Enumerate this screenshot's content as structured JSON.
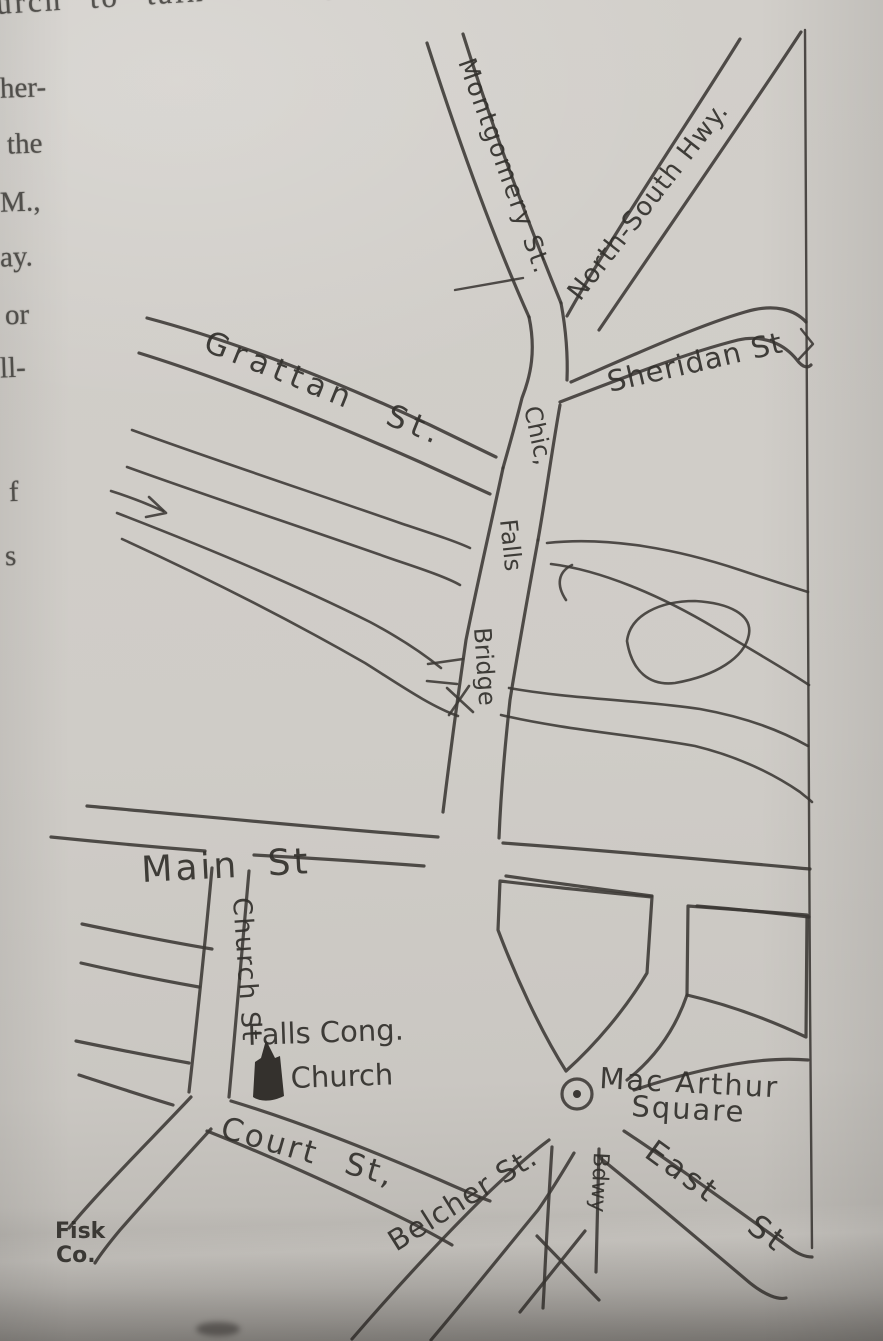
{
  "page": {
    "printed_text": {
      "top_line_start": "urch to talk over ",
      "top_line_end": "your church",
      "margin_fragments": [
        "her-",
        "the",
        "M.,",
        "ay.",
        "or",
        "ll-",
        "f",
        "s"
      ]
    }
  },
  "map": {
    "streets": {
      "montgomery": "Montgomery St.",
      "north_south_hwy": "North-South Hwy.",
      "sheridan": "Sheridan St",
      "grattan": "Grattan St.",
      "bridge_word1": "Chic,",
      "bridge_word2": "Falls",
      "bridge_word3": "Bridge",
      "main": "Main St",
      "church": "Church St",
      "court": "Court St,",
      "belcher": "Belcher St.",
      "east": "East St",
      "broadway": "Bdwy"
    },
    "landmarks": {
      "church_line1": "Falls Cong.",
      "church_line2": "Church",
      "square_line1": "Mac Arthur",
      "square_line2": "Square",
      "fisk_line1": "Fisk",
      "fisk_line2": "Co."
    },
    "colors": {
      "ink": "#3b3834",
      "paper": "#cfccc7"
    }
  }
}
